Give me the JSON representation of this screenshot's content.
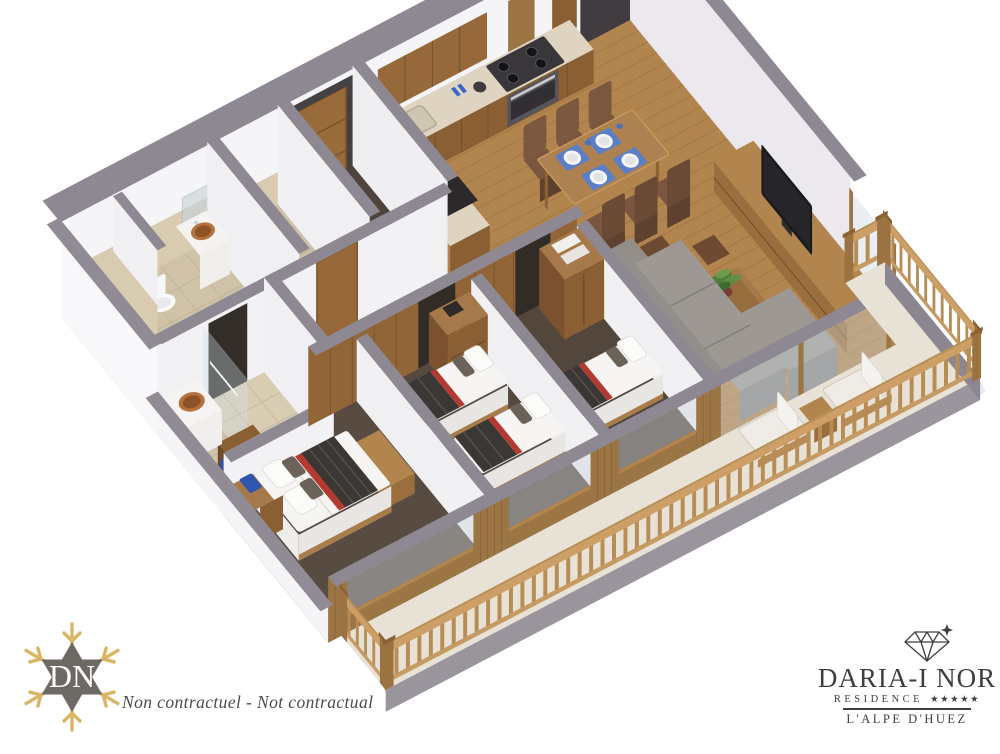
{
  "page": {
    "background": "#ffffff"
  },
  "floorplan": {
    "type": "isometric-3d-apartment-cutaway",
    "rooms": [
      "entrance-hall",
      "kitchen",
      "dining-area",
      "living-room",
      "master-bedroom",
      "twin-bedroom",
      "third-bedroom",
      "bathroom",
      "shower-room",
      "wc",
      "balcony-terrace"
    ],
    "palette": {
      "wall_cap_gray": "#8e8893",
      "wall_white": "#f5f4f6",
      "charcoal_wall": "#403c3f",
      "wood_cabinet": "#8a5f33",
      "wood_light": "#b3854e",
      "floor_wood": "#b3854e",
      "carpet_brown": "#564940",
      "tile_beige": "#cfc2a6",
      "sofa_gray": "#8f8a86",
      "dining_chair_brown": "#74513b",
      "throw_dark": "#3b3734",
      "throw_red": "#b23a30",
      "copper_basin": "#b5713d",
      "accent_blue": "#2f55b0",
      "placemat_blue": "#5b7fc7",
      "terrace_floor": "#e8e1d5",
      "railing_wood": "#c59a63",
      "tv_black": "#1b1a1c",
      "plant_green": "#4e7d3a"
    }
  },
  "disclaimer": {
    "text": "Non contractuel - Not contractual"
  },
  "logo_left": {
    "monogram": "DN",
    "gold": "#d9b565",
    "star_gray": "#6d6a66"
  },
  "logo_right": {
    "brand": "DARIA-I NOR",
    "subtitle": "RESIDENCE",
    "stars": "★★★★★",
    "location": "L'ALPE D'HUEZ",
    "ink": "#3f3e42"
  }
}
